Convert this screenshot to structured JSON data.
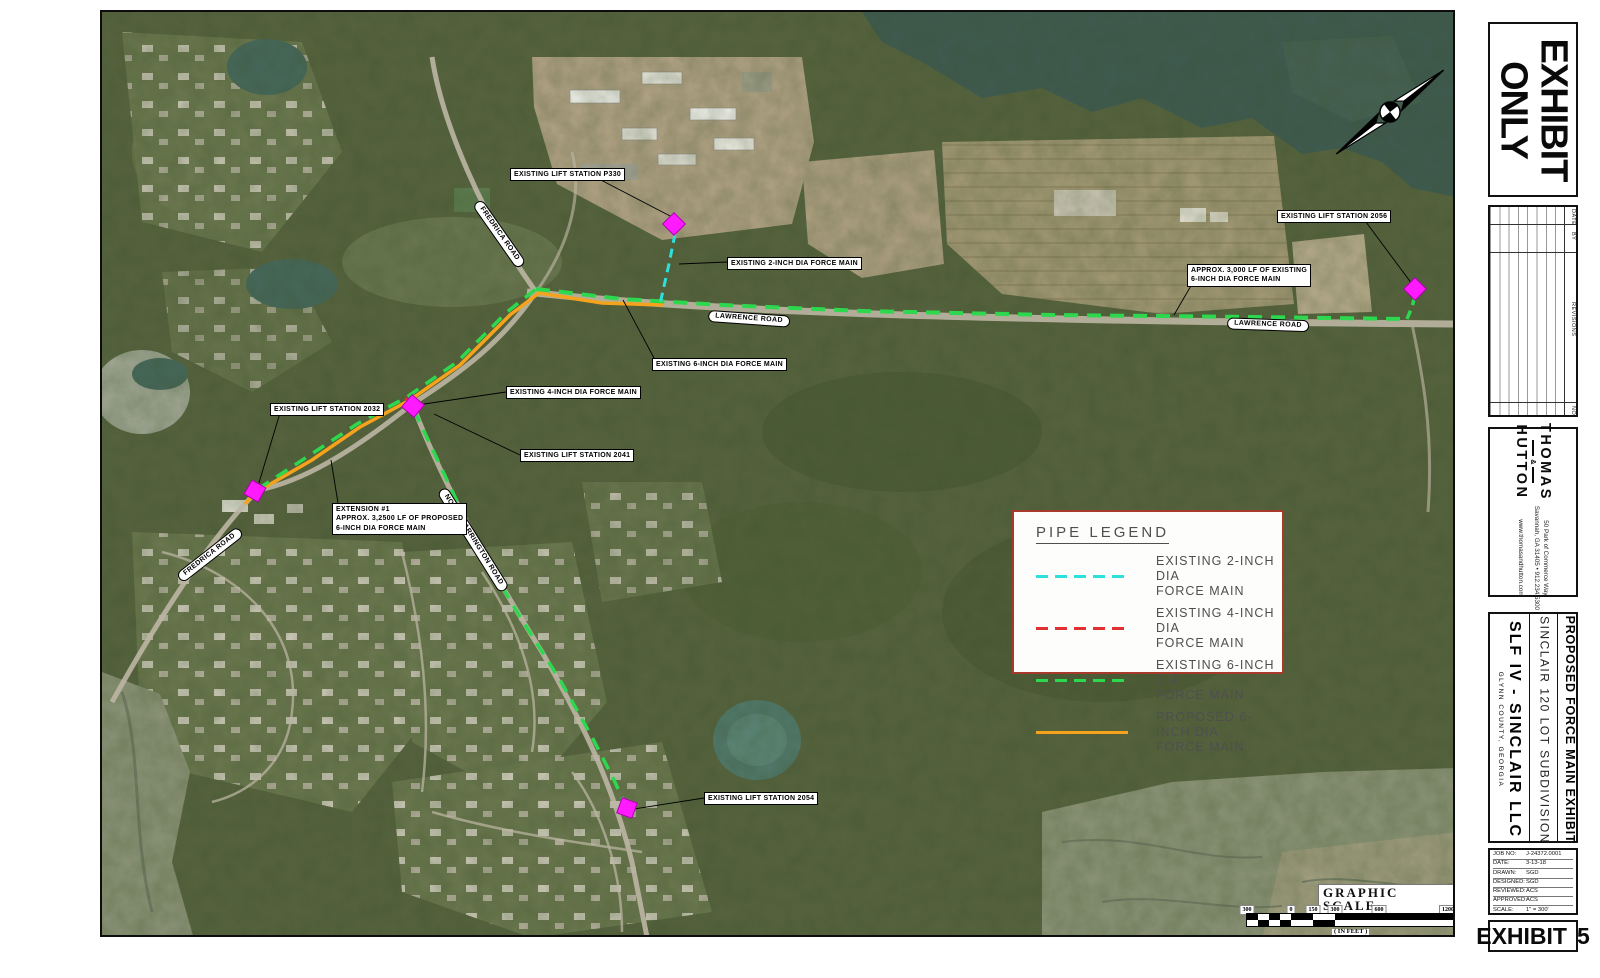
{
  "sheet": {
    "exhibit_stamp": {
      "line1": "EXHIBIT",
      "line2": "ONLY"
    },
    "revisions": {
      "col_no": "NO",
      "col_revisions": "REVISIONS",
      "col_by": "BY",
      "col_date": "DATE"
    },
    "firm": {
      "name1": "THOMAS",
      "amp": "&",
      "name2": "HUTTON",
      "address1": "50 Park of Commerce Way",
      "address2": "Savannah, GA 31405 • 912.234.5300",
      "website": "www.thomasandhutton.com"
    },
    "project": {
      "client": "SLF IV - SINCLAIR LLC",
      "location": "GLYNN COUNTY, GEORGIA",
      "name": "SINCLAIR 120 LOT SUBDIVISION",
      "sheet_title": "PROPOSED FORCE MAIN EXHIBIT"
    },
    "job": {
      "rows": [
        {
          "label": "JOB NO:",
          "value": "J-24372.0001"
        },
        {
          "label": "DATE:",
          "value": "3-13-18"
        },
        {
          "label": "DRAWN:",
          "value": "SGD"
        },
        {
          "label": "DESIGNED:",
          "value": "SGD"
        },
        {
          "label": "REVIEWED:",
          "value": "ACS"
        },
        {
          "label": "APPROVED:",
          "value": "ACS"
        },
        {
          "label": "SCALE:",
          "value": "1\" = 300'"
        }
      ]
    },
    "exhibit_label": {
      "word": "EXHIBIT",
      "number": "5"
    }
  },
  "map": {
    "legend": {
      "title": "PIPE LEGEND",
      "items": [
        {
          "label": "EXISTING 2-INCH DIA\nFORCE MAIN",
          "color": "#2ee0dd",
          "line_style": "dashed"
        },
        {
          "label": "EXISTING 4-INCH DIA\nFORCE MAIN",
          "color": "#e03030",
          "line_style": "dashed"
        },
        {
          "label": "EXISTING 6-INCH DIA\nFORCE MAIN",
          "color": "#2dd84e",
          "line_style": "dashed"
        },
        {
          "label": "PROPOSED 6-INCH DIA\nFORCE MAIN",
          "color": "#f5a21c",
          "line_style": "solid"
        }
      ]
    },
    "callouts": [
      {
        "text": "EXISTING LIFT STATION P330"
      },
      {
        "text": "EXISTING 2-INCH DIA FORCE MAIN"
      },
      {
        "text": "EXISTING 6-INCH DIA FORCE MAIN"
      },
      {
        "text": "EXISTING 4-INCH DIA FORCE MAIN"
      },
      {
        "text": "EXISTING LIFT STATION 2032"
      },
      {
        "text": "EXISTING LIFT STATION 2041"
      },
      {
        "text": "EXTENSION #1\nAPPROX. 3,2500 LF OF PROPOSED\n6-INCH DIA FORCE MAIN"
      },
      {
        "text": "EXISTING LIFT STATION 2054"
      },
      {
        "text": "EXISTING LIFT STATION 2056"
      },
      {
        "text": "APPROX. 3,000 LF OF EXISTING\n6-INCH DIA FORCE MAIN"
      }
    ],
    "road_labels": [
      {
        "text": "FREDRICA ROAD"
      },
      {
        "text": "FREDRICA ROAD"
      },
      {
        "text": "LAWRENCE ROAD"
      },
      {
        "text": "LAWRENCE ROAD"
      },
      {
        "text": "NORTH HARRINGTON ROAD"
      }
    ],
    "scale": {
      "title": "GRAPHIC SCALE",
      "ticks": [
        "300",
        "0",
        "150",
        "300",
        "600",
        "1200"
      ],
      "unit_note": "( IN FEET )",
      "ratio_note": "1 inch = 300 ft."
    },
    "colors": {
      "existing_2in": "#2ee0dd",
      "existing_4in": "#e03030",
      "existing_6in": "#2dd84e",
      "proposed_6in": "#f5a21c",
      "lift_station": "#ff1aff",
      "legend_border": "#a83a2c"
    }
  }
}
